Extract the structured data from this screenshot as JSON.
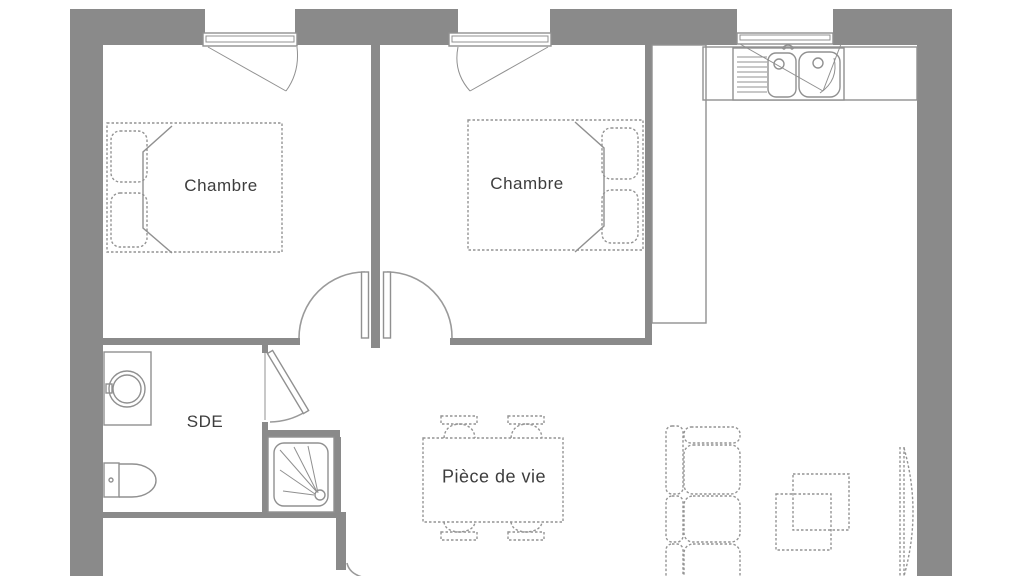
{
  "title": "Plan d'appartement",
  "rooms": {
    "bedroom1": {
      "label": "Chambre"
    },
    "bedroom2": {
      "label": "Chambre"
    },
    "bathroom": {
      "label": "SDE"
    },
    "living": {
      "label": "Pièce de vie"
    }
  },
  "colors": {
    "wall": "#8a8a8a",
    "line": "#909090",
    "furn": "#949494",
    "label": "#3d3d3d",
    "background": "#ffffff"
  }
}
